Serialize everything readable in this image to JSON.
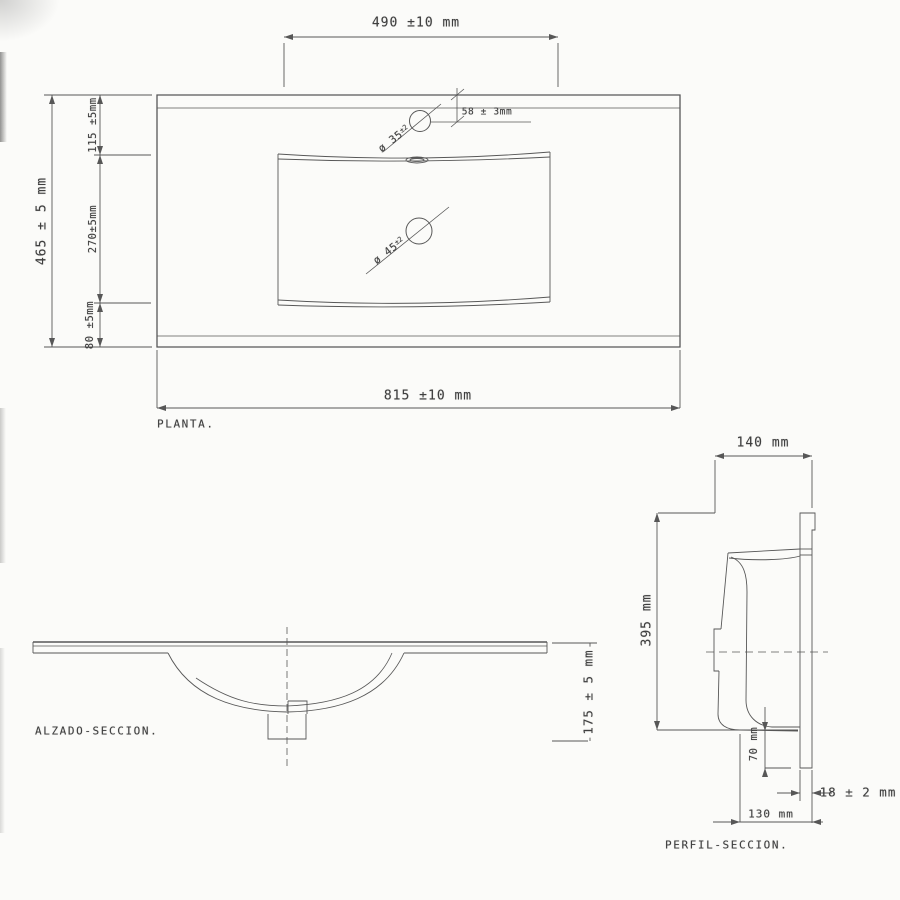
{
  "document": {
    "type": "technical-drawing",
    "subject": "vanity washbasin sink",
    "background_color": "#fbfbf9",
    "line_color": "#4a4a4a"
  },
  "views": {
    "planta": {
      "label": "PLANTA.",
      "dimensions": {
        "basin_width_top": "490 ±10 mm",
        "faucet_offset": "58 ± 3mm",
        "faucet_hole_diameter": {
          "text": "ø 35",
          "tolerance": "±2"
        },
        "drain_hole_diameter": {
          "text": "ø 45",
          "tolerance": "±2"
        },
        "depth_overall": "465 ± 5 mm",
        "depth_segment_top": "115 ±5mm",
        "depth_segment_middle": "270±5mm",
        "depth_segment_bottom": "80 ±5mm",
        "width_overall": "815 ±10 mm"
      }
    },
    "alzado": {
      "label": "ALZADO-SECCION.",
      "dimensions": {
        "total_height": "175 ± 5 mm"
      }
    },
    "perfil": {
      "label": "PERFIL-SECCION.",
      "dimensions": {
        "top_depth": "140 mm",
        "back_height": "395 mm",
        "apron_drop": "70 mm",
        "panel_thickness": "18 ± 2 mm",
        "bottom_depth": "130 mm"
      }
    }
  }
}
